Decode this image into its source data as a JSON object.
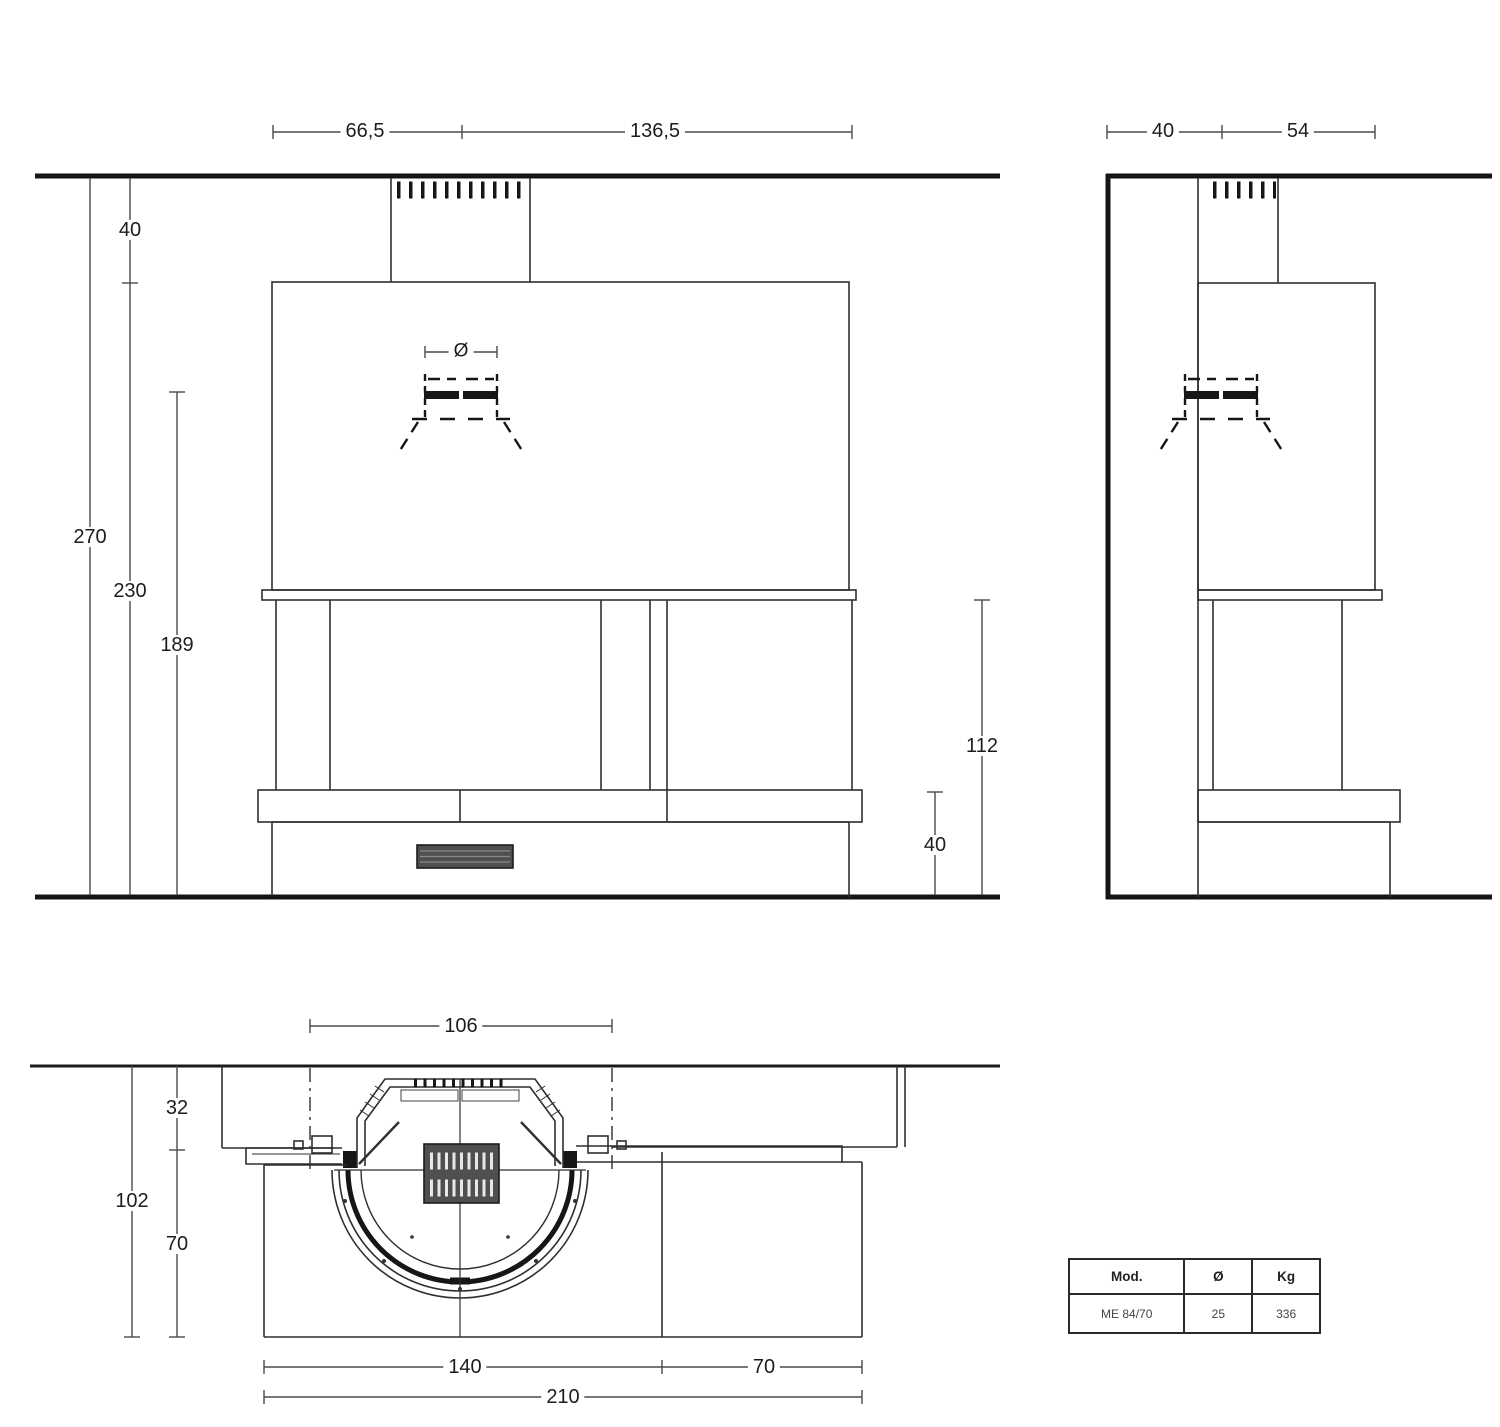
{
  "front": {
    "top_left": "66,5",
    "top_right": "136,5",
    "diameter_symbol": "Ø",
    "wall_gap": "40",
    "total_height": "270",
    "hood_height": "230",
    "collar_height": "189",
    "opening_height": "112",
    "base_height": "40"
  },
  "side": {
    "depth_wall": "40",
    "depth_front": "54"
  },
  "plan": {
    "inner_width": "106",
    "side_depth": "32",
    "total_depth": "102",
    "hearth_depth": "70",
    "firebox_width": "140",
    "bench_width": "70",
    "total_width": "210"
  },
  "spec_table": {
    "headers": [
      "Mod.",
      "Ø",
      "Kg"
    ],
    "rows": [
      [
        "ME 84/70",
        "25",
        "336"
      ]
    ]
  }
}
